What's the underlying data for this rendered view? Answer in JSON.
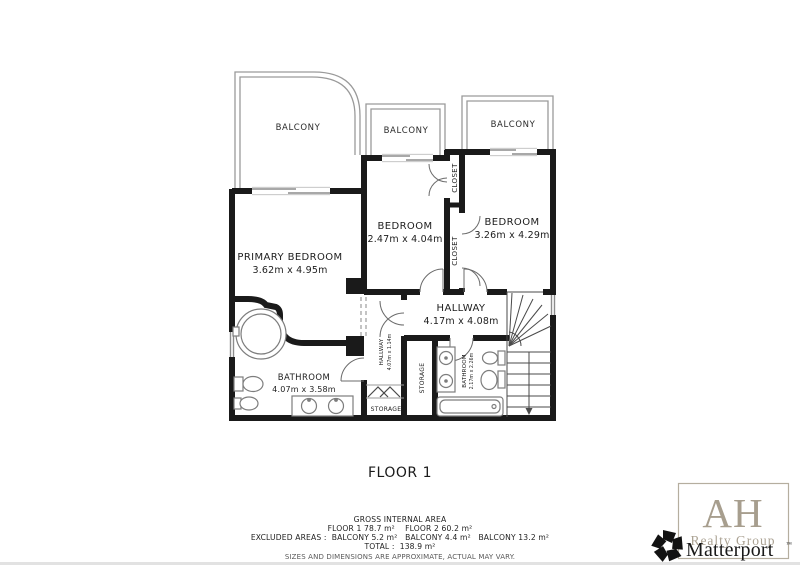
{
  "floor_plan": {
    "floor_label": "FLOOR 1",
    "balconies": [
      "BALCONY",
      "BALCONY",
      "BALCONY"
    ],
    "rooms": {
      "primary_bedroom": {
        "name": "PRIMARY BEDROOM",
        "dims": "3.62m x 4.95m"
      },
      "bedroom_middle": {
        "name": "BEDROOM",
        "dims": "2.47m x 4.04m"
      },
      "bedroom_right": {
        "name": "BEDROOM",
        "dims": "3.26m x 4.29m"
      },
      "hallway": {
        "name": "HALLWAY",
        "dims": "4.17m x 4.08m"
      },
      "bathroom": {
        "name": "BATHROOM",
        "dims": "4.07m x 3.58m"
      },
      "bathroom_small": {
        "name": "BATHROOM",
        "dims": "2.17m x 2.26m"
      },
      "hallway_small": {
        "name": "HALLWAY",
        "dims": "4.07m x 1.14m"
      },
      "closet_top": "CLOSET",
      "closet_bottom": "CLOSET",
      "storage_side": "STORAGE",
      "storage_bottom": "STORAGE"
    },
    "footer": {
      "line1": "GROSS INTERNAL AREA",
      "line2": "FLOOR 1 78.7 m²    FLOOR 2 60.2 m²",
      "line3": "EXCLUDED AREAS :  BALCONY 5.2 m²   BALCONY 4.4 m²   BALCONY 13.2 m²",
      "line4": "TOTAL :  138.9 m²",
      "line5": "SIZES AND DIMENSIONS ARE APPROXIMATE, ACTUAL MAY VARY."
    },
    "branding": {
      "ah_initials": "AH",
      "ah_subtitle": "Realty Group",
      "matterport": "Matterport",
      "trademark": "™"
    },
    "colors": {
      "wall": "#1a1a1a",
      "fixture_gray": "#7d7d7d",
      "balcony_wall": "#9a9a9a",
      "ah_taupe": "#a79e8e",
      "matterport_black": "#181818"
    }
  }
}
